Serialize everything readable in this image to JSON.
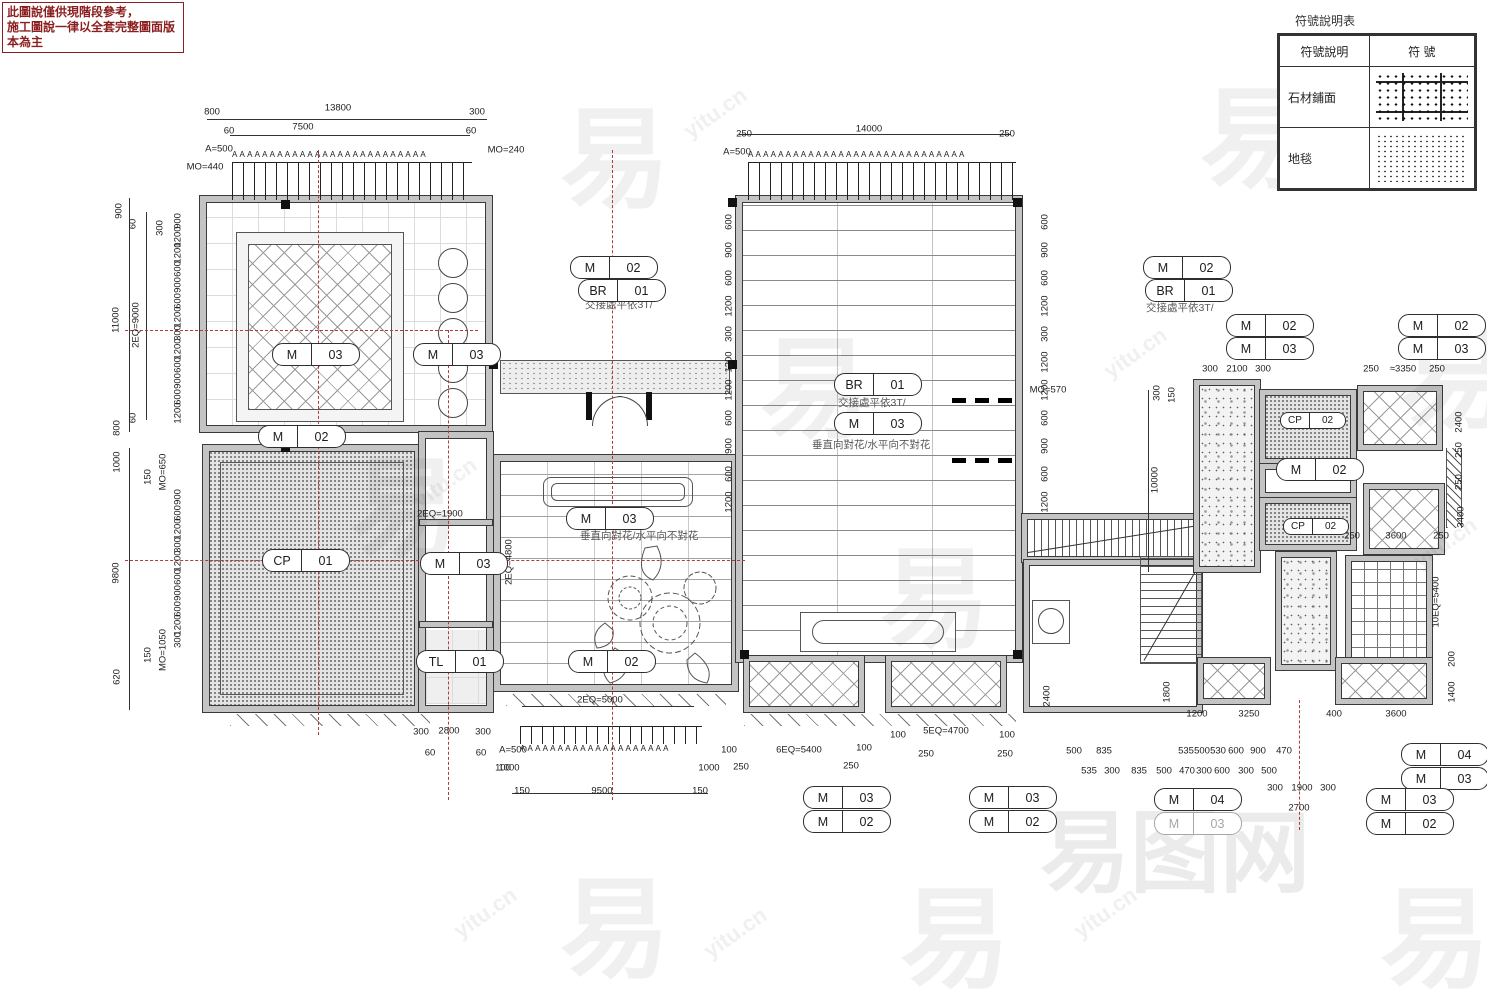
{
  "warning": {
    "line1": "此圖說僅供現階段參考，",
    "line2": "施工圖說一律以全套完整圖面版本為主"
  },
  "legend": {
    "title": "符號說明表",
    "header_desc": "符號說明",
    "header_sym": "符  號",
    "rows": [
      {
        "label": "石材鋪面"
      },
      {
        "label": "地毯"
      }
    ]
  },
  "tick_letter": "A",
  "colors": {
    "warning_red": "#8b1f1f",
    "centerline_red": "#b23a3a",
    "line_dark": "#333333",
    "wall_gray": "#c4c4c4"
  },
  "callouts": [
    {
      "a": "M",
      "b": "02",
      "x": 570,
      "y": 256
    },
    {
      "a": "BR",
      "b": "01",
      "x": 578,
      "y": 279
    },
    {
      "a": "M",
      "b": "03",
      "x": 272,
      "y": 343
    },
    {
      "a": "M",
      "b": "03",
      "x": 413,
      "y": 343
    },
    {
      "a": "M",
      "b": "02",
      "x": 258,
      "y": 425
    },
    {
      "a": "M",
      "b": "03",
      "x": 566,
      "y": 507
    },
    {
      "a": "CP",
      "b": "01",
      "x": 262,
      "y": 549
    },
    {
      "a": "M",
      "b": "03",
      "x": 420,
      "y": 552
    },
    {
      "a": "TL",
      "b": "01",
      "x": 416,
      "y": 650
    },
    {
      "a": "M",
      "b": "02",
      "x": 568,
      "y": 650
    },
    {
      "a": "BR",
      "b": "01",
      "x": 834,
      "y": 373
    },
    {
      "a": "M",
      "b": "03",
      "x": 834,
      "y": 412
    },
    {
      "a": "M",
      "b": "02",
      "x": 1143,
      "y": 256
    },
    {
      "a": "BR",
      "b": "01",
      "x": 1145,
      "y": 279
    },
    {
      "a": "M",
      "b": "02",
      "x": 1226,
      "y": 314
    },
    {
      "a": "M",
      "b": "03",
      "x": 1226,
      "y": 337
    },
    {
      "a": "M",
      "b": "02",
      "x": 1398,
      "y": 314
    },
    {
      "a": "M",
      "b": "03",
      "x": 1398,
      "y": 337
    },
    {
      "a": "CP",
      "b": "02",
      "x": 1280,
      "y": 412,
      "s": true
    },
    {
      "a": "M",
      "b": "02",
      "x": 1276,
      "y": 458
    },
    {
      "a": "CP",
      "b": "02",
      "x": 1283,
      "y": 518,
      "s": true
    },
    {
      "a": "M",
      "b": "03",
      "x": 803,
      "y": 786
    },
    {
      "a": "M",
      "b": "02",
      "x": 803,
      "y": 810
    },
    {
      "a": "M",
      "b": "03",
      "x": 969,
      "y": 786
    },
    {
      "a": "M",
      "b": "02",
      "x": 969,
      "y": 810
    },
    {
      "a": "M",
      "b": "04",
      "x": 1154,
      "y": 788
    },
    {
      "a": "M",
      "b": "03",
      "x": 1154,
      "y": 812,
      "m": true
    },
    {
      "a": "M",
      "b": "04",
      "x": 1401,
      "y": 743
    },
    {
      "a": "M",
      "b": "03",
      "x": 1401,
      "y": 767
    },
    {
      "a": "M",
      "b": "03",
      "x": 1366,
      "y": 788
    },
    {
      "a": "M",
      "b": "02",
      "x": 1366,
      "y": 812
    }
  ],
  "notes": [
    {
      "t": "交接處平依3T/",
      "x": 585,
      "y": 297
    },
    {
      "t": "垂直向對花/水平向不對花",
      "x": 580,
      "y": 528
    },
    {
      "t": "交接處平依3T/",
      "x": 838,
      "y": 395
    },
    {
      "t": "垂直向對花/水平向不對花",
      "x": 812,
      "y": 437
    },
    {
      "t": "交接處平依3T/",
      "x": 1146,
      "y": 300
    }
  ],
  "bands": [
    {
      "x": 232,
      "y": 150,
      "w": 240,
      "n": 26
    },
    {
      "x": 748,
      "y": 150,
      "w": 268,
      "n": 29
    },
    {
      "x": 520,
      "y": 744,
      "w": 182,
      "n": 20
    }
  ],
  "dims": [
    [
      "800",
      212,
      112
    ],
    [
      "13800",
      338,
      108
    ],
    [
      "300",
      477,
      112
    ],
    [
      "60",
      229,
      131
    ],
    [
      "7500",
      303,
      127
    ],
    [
      "60",
      471,
      131
    ],
    [
      "A=500",
      219,
      149
    ],
    [
      "MO=240",
      506,
      150
    ],
    [
      "MO=440",
      205,
      167
    ],
    [
      "250",
      744,
      134
    ],
    [
      "14000",
      869,
      129
    ],
    [
      "250",
      1007,
      134
    ],
    [
      "A=500",
      737,
      152
    ],
    [
      "900",
      119,
      211,
      1
    ],
    [
      "11000",
      116,
      320,
      1
    ],
    [
      "2EQ=9000",
      136,
      325,
      1
    ],
    [
      "800",
      117,
      428,
      1
    ],
    [
      "60",
      133,
      224,
      1
    ],
    [
      "60",
      133,
      418,
      1
    ],
    [
      "1000",
      117,
      462,
      1
    ],
    [
      "9800",
      116,
      573,
      1
    ],
    [
      "620",
      117,
      677,
      1
    ],
    [
      "150",
      148,
      477,
      1
    ],
    [
      "MO=650",
      163,
      472,
      1
    ],
    [
      "150",
      148,
      655,
      1
    ],
    [
      "MO=1050",
      163,
      650,
      1
    ],
    [
      "300",
      160,
      228,
      1
    ],
    [
      "900",
      178,
      221,
      1
    ],
    [
      "1200",
      178,
      237,
      1
    ],
    [
      "1200",
      178,
      253,
      1
    ],
    [
      "600",
      178,
      269,
      1
    ],
    [
      "900",
      178,
      285,
      1
    ],
    [
      "600",
      178,
      301,
      1
    ],
    [
      "1200",
      178,
      317,
      1
    ],
    [
      "300",
      178,
      333,
      1
    ],
    [
      "1200",
      178,
      349,
      1
    ],
    [
      "600",
      178,
      365,
      1
    ],
    [
      "900",
      178,
      381,
      1
    ],
    [
      "600",
      178,
      397,
      1
    ],
    [
      "1200",
      178,
      413,
      1
    ],
    [
      "900",
      178,
      497,
      1
    ],
    [
      "600",
      178,
      513,
      1
    ],
    [
      "1200",
      178,
      529,
      1
    ],
    [
      "300",
      178,
      545,
      1
    ],
    [
      "1200",
      178,
      561,
      1
    ],
    [
      "600",
      178,
      577,
      1
    ],
    [
      "900",
      178,
      593,
      1
    ],
    [
      "600",
      178,
      609,
      1
    ],
    [
      "1200",
      178,
      625,
      1
    ],
    [
      "300",
      178,
      640,
      1
    ],
    [
      "600",
      729,
      222,
      1
    ],
    [
      "900",
      729,
      250,
      1
    ],
    [
      "600",
      729,
      278,
      1
    ],
    [
      "1200",
      729,
      306,
      1
    ],
    [
      "300",
      729,
      334,
      1
    ],
    [
      "1200",
      729,
      362,
      1
    ],
    [
      "1200",
      729,
      390,
      1
    ],
    [
      "600",
      729,
      418,
      1
    ],
    [
      "900",
      729,
      446,
      1
    ],
    [
      "600",
      729,
      474,
      1
    ],
    [
      "1200",
      729,
      502,
      1
    ],
    [
      "600",
      1045,
      222,
      1
    ],
    [
      "900",
      1045,
      250,
      1
    ],
    [
      "600",
      1045,
      278,
      1
    ],
    [
      "1200",
      1045,
      306,
      1
    ],
    [
      "300",
      1045,
      334,
      1
    ],
    [
      "1200",
      1045,
      362,
      1
    ],
    [
      "1200",
      1045,
      390,
      1
    ],
    [
      "600",
      1045,
      418,
      1
    ],
    [
      "900",
      1045,
      446,
      1
    ],
    [
      "600",
      1045,
      474,
      1
    ],
    [
      "1200",
      1045,
      502,
      1
    ],
    [
      "MO=570",
      1048,
      390
    ],
    [
      "300",
      1157,
      393,
      1
    ],
    [
      "150",
      1172,
      395,
      1
    ],
    [
      "10000",
      1155,
      480,
      1
    ],
    [
      "300",
      1210,
      369
    ],
    [
      "2100",
      1237,
      369
    ],
    [
      "300",
      1263,
      369
    ],
    [
      "250",
      1371,
      369
    ],
    [
      "≈3350",
      1403,
      369
    ],
    [
      "250",
      1437,
      369
    ],
    [
      "2400",
      1459,
      422,
      1
    ],
    [
      "250",
      1459,
      450,
      1
    ],
    [
      "250",
      1459,
      482,
      1
    ],
    [
      "3400",
      1461,
      517,
      1
    ],
    [
      "250",
      1352,
      536
    ],
    [
      "3600",
      1396,
      536
    ],
    [
      "250",
      1441,
      536
    ],
    [
      "2EQ=1900",
      440,
      514
    ],
    [
      "2EQ=4800",
      509,
      562,
      1
    ],
    [
      "2EQ=5000",
      600,
      700
    ],
    [
      "A=500",
      513,
      750
    ],
    [
      "1000",
      509,
      768
    ],
    [
      "1000",
      709,
      768
    ],
    [
      "150",
      522,
      791
    ],
    [
      "9500",
      602,
      791
    ],
    [
      "150",
      700,
      791
    ],
    [
      "100",
      729,
      750
    ],
    [
      "250",
      741,
      767
    ],
    [
      "300",
      421,
      732
    ],
    [
      "2800",
      449,
      731
    ],
    [
      "300",
      483,
      732
    ],
    [
      "60",
      430,
      753
    ],
    [
      "60",
      481,
      753
    ],
    [
      "100",
      503,
      768
    ],
    [
      "6EQ=5400",
      799,
      750
    ],
    [
      "100",
      864,
      748
    ],
    [
      "250",
      851,
      766
    ],
    [
      "100",
      898,
      735
    ],
    [
      "5EQ=4700",
      946,
      731
    ],
    [
      "100",
      1007,
      735
    ],
    [
      "250",
      926,
      754
    ],
    [
      "250",
      1005,
      754
    ],
    [
      "500",
      1074,
      751
    ],
    [
      "835",
      1104,
      751
    ],
    [
      "535",
      1186,
      751
    ],
    [
      "500",
      1202,
      751
    ],
    [
      "530",
      1218,
      751
    ],
    [
      "600",
      1236,
      751
    ],
    [
      "900",
      1258,
      751
    ],
    [
      "470",
      1284,
      751
    ],
    [
      "535",
      1089,
      771
    ],
    [
      "300",
      1112,
      771
    ],
    [
      "835",
      1139,
      771
    ],
    [
      "500",
      1164,
      771
    ],
    [
      "470",
      1187,
      771
    ],
    [
      "300",
      1204,
      771
    ],
    [
      "600",
      1222,
      771
    ],
    [
      "300",
      1246,
      771
    ],
    [
      "500",
      1269,
      771
    ],
    [
      "1200",
      1197,
      714
    ],
    [
      "3250",
      1249,
      714
    ],
    [
      "400",
      1334,
      714
    ],
    [
      "3600",
      1396,
      714
    ],
    [
      "2400",
      1047,
      696,
      1
    ],
    [
      "1800",
      1167,
      692,
      1
    ],
    [
      "10EQ=5400",
      1436,
      602,
      1
    ],
    [
      "200",
      1452,
      659,
      1
    ],
    [
      "1400",
      1452,
      692,
      1
    ],
    [
      "300",
      1275,
      788
    ],
    [
      "1900",
      1302,
      788
    ],
    [
      "300",
      1328,
      788
    ],
    [
      "2700",
      1299,
      808
    ]
  ],
  "watermarks": [
    {
      "t": "易",
      "x": 560,
      "y": 70,
      "s": 110
    },
    {
      "t": "易",
      "x": 350,
      "y": 420,
      "s": 110
    },
    {
      "t": "易",
      "x": 760,
      "y": 300,
      "s": 110
    },
    {
      "t": "易",
      "x": 880,
      "y": 510,
      "s": 110
    },
    {
      "t": "易",
      "x": 1200,
      "y": 50,
      "s": 110
    },
    {
      "t": "易",
      "x": 1400,
      "y": 290,
      "s": 110
    },
    {
      "t": "易",
      "x": 560,
      "y": 840,
      "s": 110
    },
    {
      "t": "易",
      "x": 900,
      "y": 850,
      "s": 110
    },
    {
      "t": "易",
      "x": 1380,
      "y": 850,
      "s": 110
    },
    {
      "t": "易图网",
      "x": 1040,
      "y": 780,
      "s": 90,
      "o": 0.1
    },
    {
      "t": "yitu.cn",
      "x": 680,
      "y": 100,
      "s": 22,
      "r": -35
    },
    {
      "t": "yitu.cn",
      "x": 1310,
      "y": 110,
      "s": 22,
      "r": -35
    },
    {
      "t": "yitu.cn",
      "x": 410,
      "y": 470,
      "s": 22,
      "r": -35
    },
    {
      "t": "yitu.cn",
      "x": 1100,
      "y": 340,
      "s": 22,
      "r": -35
    },
    {
      "t": "yitu.cn",
      "x": 450,
      "y": 900,
      "s": 22,
      "r": -35
    },
    {
      "t": "yitu.cn",
      "x": 1410,
      "y": 530,
      "s": 22,
      "r": -35
    },
    {
      "t": "yitu.cn",
      "x": 700,
      "y": 920,
      "s": 22,
      "r": -35
    },
    {
      "t": "yitu.cn",
      "x": 1070,
      "y": 900,
      "s": 22,
      "r": -35
    }
  ]
}
